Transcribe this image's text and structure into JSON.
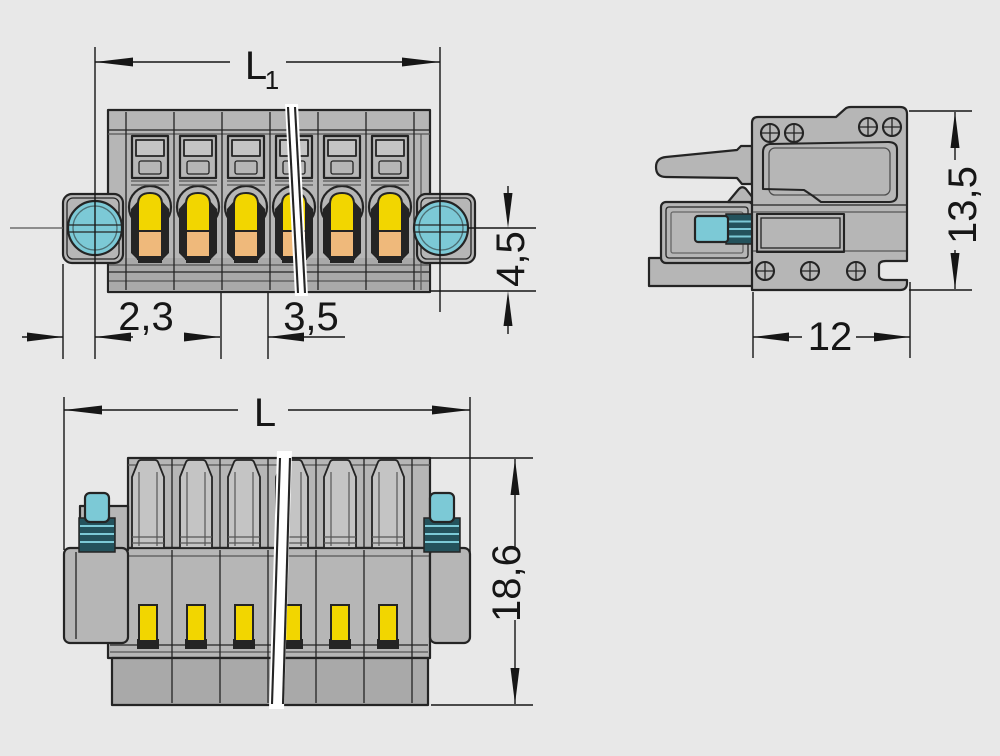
{
  "figure": {
    "kind": "technical dimension drawing",
    "views_shown": [
      "front view with break line",
      "side view",
      "bottom view with break line"
    ]
  },
  "colors": {
    "bg": "#e8e8e8",
    "body": "#b6b6b6",
    "body_light": "#c4c4c4",
    "body_dark": "#a9a9a9",
    "outline": "#242424",
    "screw_teal": "#7cc9d6",
    "screw_teal_dark": "#24525c",
    "lever_yellow": "#f2d600",
    "spring_orange": "#efb97b",
    "break_white": "#ffffff",
    "dim_color": "#161616"
  },
  "views": {
    "front": {
      "pole_centers": [
        150,
        198,
        246,
        294,
        342,
        390
      ],
      "dims": {
        "width_screws_main": "L",
        "width_screws_sub": "1",
        "edge_to_screw": "2,3",
        "pole_pitch": "3,5",
        "lower_height": "4,5"
      }
    },
    "side": {
      "dims": {
        "height": "13,5",
        "depth": "12"
      }
    },
    "bottom": {
      "pole_centers": [
        148,
        196,
        244,
        292,
        340,
        388
      ],
      "dims": {
        "overall_width": "L",
        "height": "18,6"
      }
    }
  }
}
